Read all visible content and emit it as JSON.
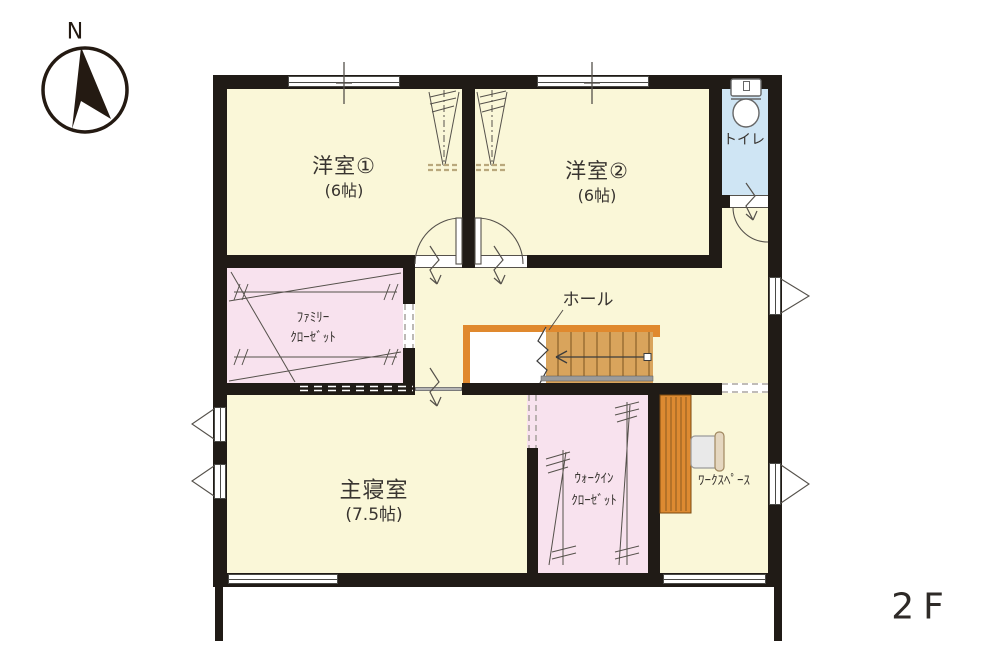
{
  "floor_label": "2F",
  "compass": {
    "north": "N"
  },
  "rooms": {
    "western_room_1": {
      "name": "洋室①",
      "size": "(6帖)"
    },
    "western_room_2": {
      "name": "洋室②",
      "size": "(6帖)"
    },
    "toilet": {
      "name": "トイレ"
    },
    "family_closet": {
      "line1": "ﾌｧﾐﾘｰ",
      "line2": "ｸﾛｰｾﾞｯﾄ"
    },
    "hall": {
      "name": "ホール"
    },
    "master_bedroom": {
      "name": "主寝室",
      "size": "(7.5帖)"
    },
    "walk_in_closet": {
      "line1": "ｳｫｰｸｲﾝ",
      "line2": "ｸﾛｰｾﾞｯﾄ"
    },
    "workspace": {
      "name": "ﾜｰｸｽﾍﾟｰｽ"
    }
  },
  "colors": {
    "room_fill": "#faf7d8",
    "closet_fill": "#f8e2ee",
    "toilet_fill": "#cfe5f4",
    "wall": "#201b16",
    "stair_wood_frame": "#e0892e",
    "stair_tread": "#d9a45c",
    "handrail_grey": "#9b9b9b"
  }
}
